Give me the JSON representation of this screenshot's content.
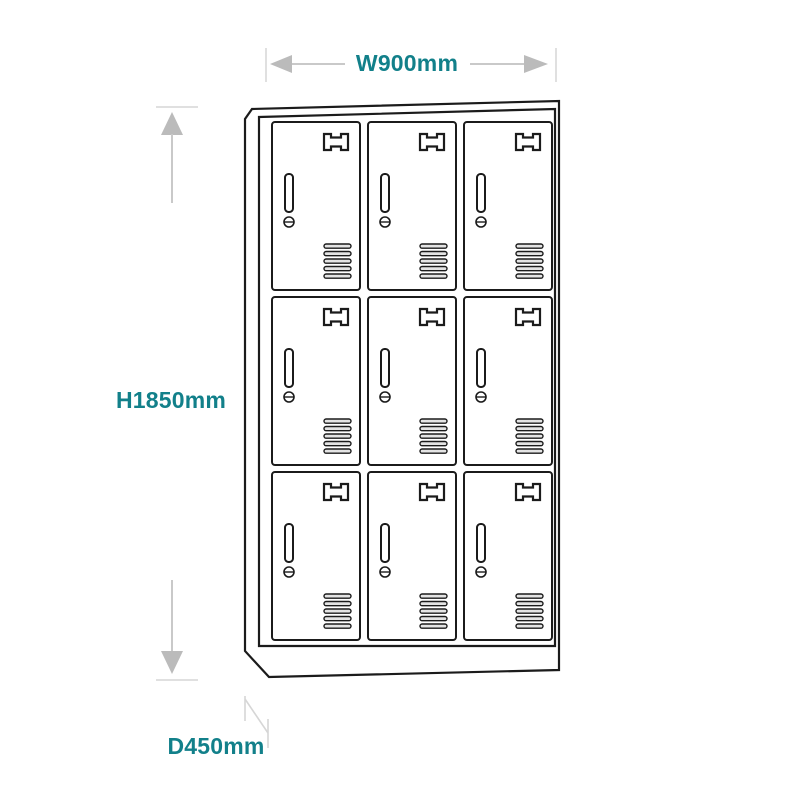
{
  "diagram": {
    "type": "product-line-drawing",
    "subject": "nine-door-locker-cabinet",
    "dimensions": {
      "width": {
        "label": "W900mm",
        "value_mm": 900,
        "axis": "width"
      },
      "height": {
        "label": "H1850mm",
        "value_mm": 1850,
        "axis": "height"
      },
      "depth": {
        "label": "D450mm",
        "value_mm": 450,
        "axis": "depth"
      }
    },
    "locker": {
      "rows": 3,
      "columns": 3,
      "door_count": 9,
      "door_features": [
        "door-handle",
        "lock-slot",
        "cam-lock",
        "vent-grille"
      ]
    },
    "icons": {
      "width_arrows": [
        "arrow-left-icon",
        "arrow-right-icon"
      ],
      "height_arrows": [
        "arrow-up-icon",
        "arrow-down-icon"
      ]
    },
    "colors": {
      "accent": "#12808A",
      "line": "#1B1B1B",
      "arrow_head": "#BBBBBB",
      "arrow_shaft": "#C9C9C9",
      "extension_tick": "#E0E0E0",
      "depth_line": "#D6D6D6",
      "vent_fill": "#E4E4E4",
      "background": "#FFFFFF"
    }
  }
}
